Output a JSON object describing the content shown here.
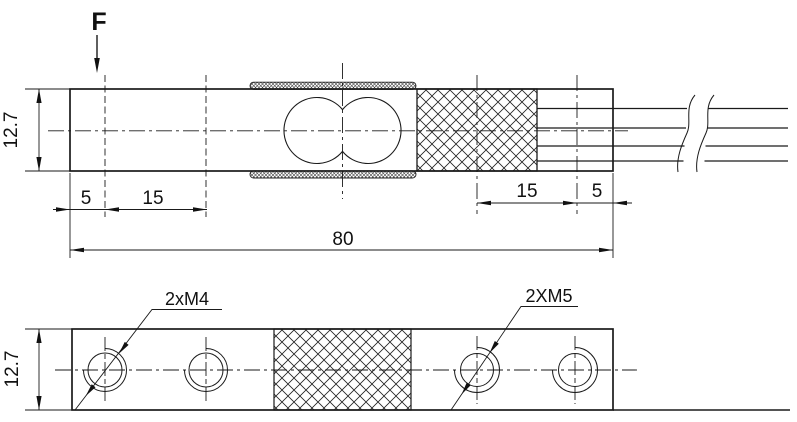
{
  "drawing": {
    "force_label": "F",
    "side_view": {
      "height_mm": "12.7",
      "left_end_to_first_hole": "5",
      "left_hole_spacing": "15",
      "right_hole_spacing": "15",
      "right_end_to_last_hole": "5",
      "total_length": "80"
    },
    "bottom_view": {
      "height_mm": "12.7",
      "left_threads_label": "2xM4",
      "right_threads_label": "2XM5"
    },
    "colors": {
      "line": "#1a1a1a",
      "background": "#ffffff"
    }
  }
}
